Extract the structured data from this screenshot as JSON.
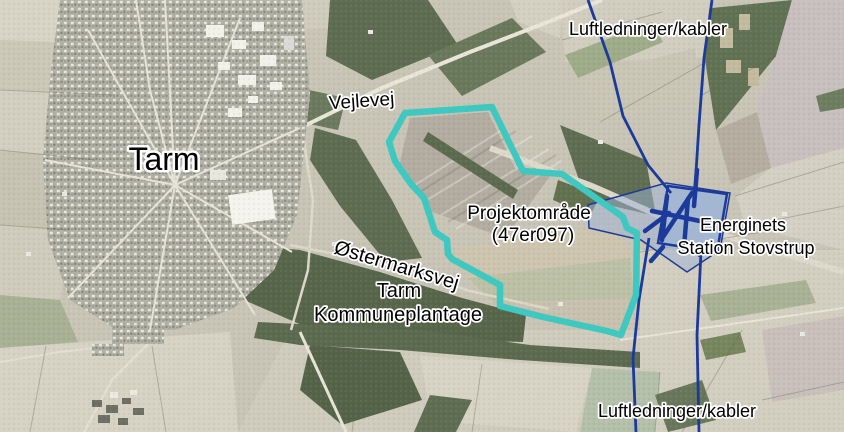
{
  "figure": {
    "type": "aerial-map",
    "labels": {
      "overhead_lines_top": "Luftledninger/kabler",
      "overhead_lines_bottom": "Luftledninger/kabler",
      "road_vejlevej": "Vejlevej",
      "town_tarm": "Tarm",
      "project_area": {
        "line1": "Projektområde",
        "line2": "(47er097)"
      },
      "road_ostermarksvej": "Østermarksvej",
      "plantation": {
        "line1": "Tarm",
        "line2": "Kommuneplantage"
      },
      "station": {
        "line1": "Energinets",
        "line2": "Station Stovstrup"
      }
    },
    "colors": {
      "project_outline": "#3fc8c0",
      "power_line": "#1c3a99",
      "station_fill": "#9db4d6",
      "station_border": "#1c3a99",
      "label_text": "#000000",
      "label_halo": "#ffffff"
    }
  }
}
